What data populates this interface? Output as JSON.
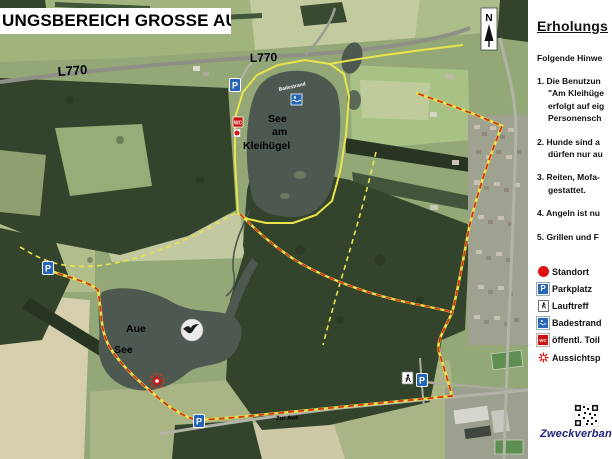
{
  "title": "UNGSBEREICH GROSSE AUE",
  "panel": {
    "heading": "Erholungs",
    "intro": "Folgende Hinwe",
    "rules": [
      {
        "lines": [
          "1. Die Benutzun",
          "\"Am Kleihüge",
          "erfolgt auf eig",
          "Personensch"
        ]
      },
      {
        "lines": [
          "2. Hunde sind a",
          "dürfen nur au"
        ]
      },
      {
        "lines": [
          "3. Reiten, Mofa-",
          "gestattet."
        ]
      },
      {
        "lines": [
          "4. Angeln ist nu"
        ]
      },
      {
        "lines": [
          "5. Grillen und F"
        ]
      }
    ],
    "legend": [
      {
        "icon": "standort-icon",
        "label": "Standort"
      },
      {
        "icon": "parkplatz-icon",
        "label": "Parkplatz"
      },
      {
        "icon": "lauftreff-icon",
        "label": "Lauftreff"
      },
      {
        "icon": "badestrand-icon",
        "label": "Badestrand"
      },
      {
        "icon": "wc-icon",
        "label": "öffentl. Toil"
      },
      {
        "icon": "aussichtspunkt-icon",
        "label": "Aussichtsp"
      }
    ],
    "footer": "Zweckverban"
  },
  "map": {
    "north_label": "N",
    "road_label_1": "L770",
    "road_label_2": "L770",
    "street_label": "Zur Aue",
    "lake_kleihuegel": {
      "line1": "See",
      "line2": "am",
      "line3": "Kleihügel"
    },
    "lake_aue": {
      "line1": "Aue",
      "line2": "See"
    },
    "badestrand_label": "Badestrand",
    "parkplatz_letter": "P",
    "wc_text": "WC"
  },
  "colors": {
    "trail_yellow": "#e9e44c",
    "boundary_red": "#d5350e",
    "marker_blue": "#2565b5",
    "marker_red": "#dd1111",
    "footer_blue": "#23237a"
  }
}
